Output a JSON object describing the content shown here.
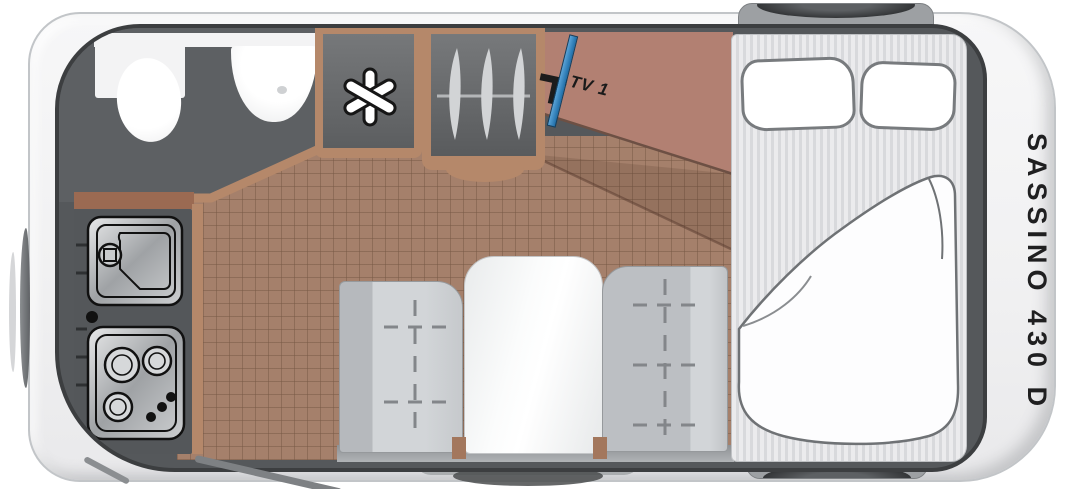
{
  "vehicle": {
    "model_label": "SASSINO 430 D",
    "type_note": "caravan floor plan, top view"
  },
  "labels": {
    "tv": "TV 1"
  },
  "rooms": {
    "bathroom": {
      "fixtures": [
        "toilet",
        "corner-washbasin",
        "counter"
      ]
    },
    "kitchen": {
      "fixtures": [
        "sink-with-faucet",
        "three-burner-stove",
        "drawers"
      ]
    },
    "storage": {
      "fixtures": [
        "refrigerator (snowflake symbol)",
        "wardrobe with 3 hangers"
      ]
    },
    "dinette": {
      "fixtures": [
        "left-bench",
        "table",
        "right-bench"
      ]
    },
    "bedroom": {
      "fixtures": [
        "double-bed-mattress",
        "pillow-left",
        "pillow-right",
        "duvet"
      ]
    }
  },
  "exterior": {
    "features": [
      "wheel-top",
      "wheel-bottom",
      "entry-step-skirt",
      "entry-door-swing",
      "front-drawbar-seam"
    ]
  },
  "icons": {
    "fridge": "snowflake-asterisk",
    "wardrobe": "clothes-hangers-on-rail",
    "tv": "flat-screen-diagonal-blue"
  },
  "colors": {
    "wall_dark": "#55585b",
    "wall_border": "#3c3e40",
    "floor_tile": "#a5806b",
    "wood_trim": "#b5886a",
    "wood_trim_red": "#9b6a52",
    "sideboard_brown": "#b28072",
    "bench_gray": "#c6c9cc",
    "table_white": "#fbfcfc",
    "mattress_stripe": "#d8d9dc",
    "tv_blue": "#2f83c0",
    "text_black": "#1f1f20",
    "body_white": "#f3f3f4"
  }
}
